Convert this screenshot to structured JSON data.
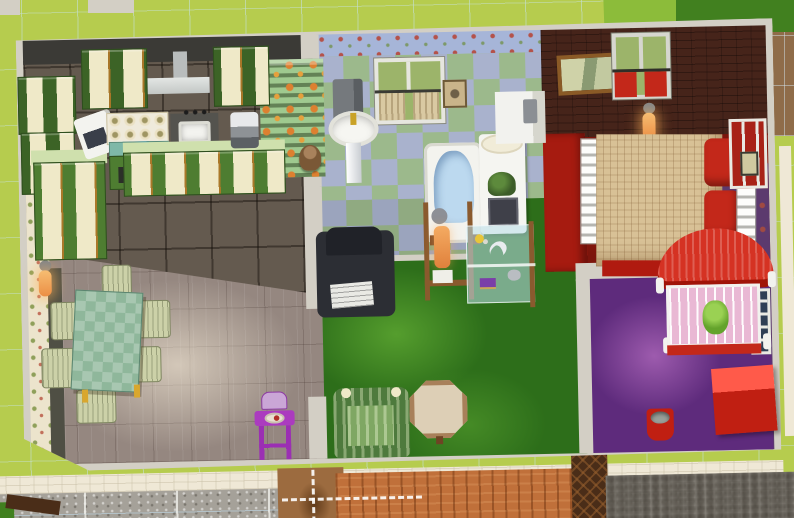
{
  "app": {
    "title": "Life-simulation game — overhead dollhouse view of a furnished home"
  },
  "palette": {
    "grass": "#b6cc4e",
    "grass_mid": "#8cbc3a",
    "grass_dark": "#41801f",
    "dirt": "#8f6c49",
    "wall": "#d3cfc5",
    "wall_dark": "#3b3a36",
    "siding": "#f0c23c",
    "pavement": "#efe8d6",
    "gravel": "#a5a199",
    "deck": "#c0703a",
    "fence": "#4a2d18",
    "dirt_path": "#9c6b3f",
    "kitchen_floor": "#645a4f",
    "dining_floor": "#958780",
    "cabinet": "#4e7d31",
    "cabinet_dark": "#3c6326",
    "counter": "#cfe0ad",
    "fruit_wall": "#9fc98f",
    "cream_wall": "#ece4cc",
    "bath_wall": "#a6b5d8",
    "tile_green": "#9cb98c",
    "tile_blue": "#a9b2cd",
    "carpet": "#2d6e1a",
    "bedroom_wall": "#46241a",
    "bedroom_floor": "#7c150c",
    "red_wall": "#a61b10",
    "nursery_floor": "#5e2b7c",
    "nursery_wall": "#5c3a6e",
    "red": "#c3281a",
    "crib_red": "#d53223",
    "table_green": "#8fb79b",
    "chair": "#ccd1a8",
    "high_chair": "#ab3bbf",
    "armchair_green": "#4e7a3d",
    "recliner": "#2c2e34",
    "wood": "#8a5a2e",
    "tan": "#d9c9a2",
    "blanket_tan": "#d8c196",
    "tub_water": "#bcd9ef",
    "glass_green": "#9cb46a",
    "white_fixture": "#f3f3ef",
    "sconce_glow": "#f2a35c"
  },
  "rooms": {
    "kitchen": {
      "name": "kitchen",
      "objects": [
        "wall cabinets",
        "range hood",
        "microwave",
        "stove",
        "kitchen sink",
        "coffee maker",
        "base cabinets with counter",
        "teddy bear",
        "orange-print wall"
      ]
    },
    "dining": {
      "name": "dining room",
      "objects": [
        "green checkered table",
        "six windsor chairs",
        "purple high chair with food tray",
        "wall sconce"
      ]
    },
    "bathroom": {
      "name": "bathroom",
      "objects": [
        "curtained window",
        "wall towel",
        "pedestal sink",
        "bathtub",
        "white dresser with plant",
        "corner counter",
        "paper holder"
      ]
    },
    "living": {
      "name": "living room",
      "objects": [
        "dark recliner with papers",
        "green striped armchair",
        "octagonal table",
        "glass display shelf with dolphin figurine",
        "wooden stand with candle"
      ]
    },
    "bedroom": {
      "name": "bedroom",
      "objects": [
        "framed landscape painting",
        "window with red curtains",
        "double bed with plaid blanket",
        "red pillows",
        "side window with red panes",
        "wall sconce"
      ]
    },
    "nursery": {
      "name": "nursery",
      "objects": [
        "red canopy crib with baby",
        "red toy box",
        "red bucket",
        "side window",
        "wall sconce"
      ]
    }
  },
  "exterior": {
    "objects": [
      "lawn with build grid",
      "dark lawn corner",
      "dirt patch",
      "yellow siding",
      "stone edging path",
      "gravel walkway with grid",
      "dirt trail with dashed route markers",
      "wooden deck",
      "dark trellis gate",
      "footprints in gravel"
    ]
  }
}
